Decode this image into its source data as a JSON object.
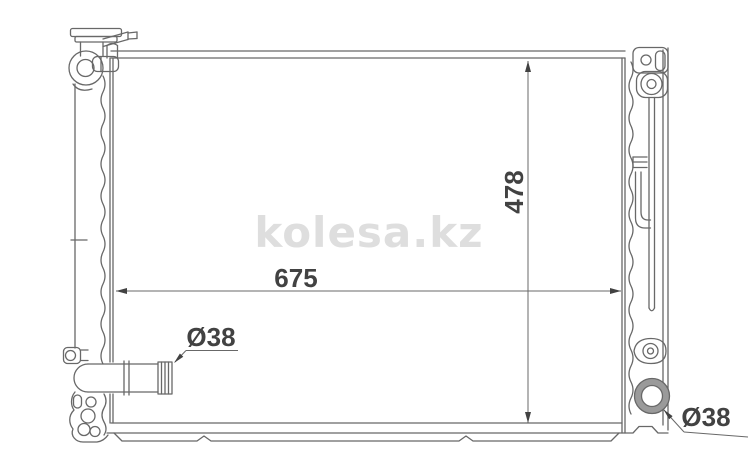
{
  "watermark": {
    "text": "kolesa.kz"
  },
  "dimensions": {
    "core_width": "675",
    "core_height": "478",
    "inlet_diameter": "Ø38",
    "outlet_diameter": "Ø38"
  },
  "colors": {
    "background": "#ffffff",
    "line": "#686868",
    "dimension_text": "#424242",
    "watermark": "#dedede",
    "port_shade": "#9a9a9a"
  }
}
